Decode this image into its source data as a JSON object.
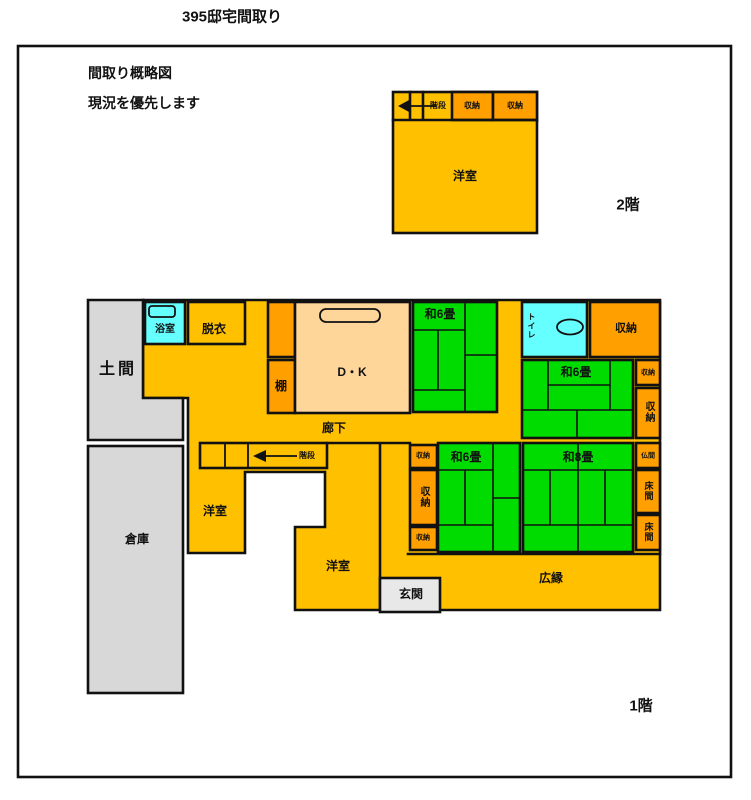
{
  "title": "395邸宅間取り",
  "notes": {
    "line1": "間取り概略図",
    "line2": "現況を優先します"
  },
  "floor_labels": {
    "second": "2階",
    "first": "1階"
  },
  "colors": {
    "yellow": "#FFC000",
    "orange": "#FF9F00",
    "green": "#00DC00",
    "cyan": "#66FFFF",
    "gray": "#D8D8D8",
    "gray_light": "#E8E8E8",
    "tan": "#FFD699",
    "white": "#FFFFFF",
    "wall": "#111111"
  },
  "floor2": {
    "stairs": "階段",
    "closet1": "収納",
    "closet2": "収納",
    "western_room": "洋室"
  },
  "floor1": {
    "doma": "土間",
    "bath": "浴室",
    "dressing": "脱衣",
    "shelf": "棚",
    "dk": "D・K",
    "tatami6_top": "和6畳",
    "toilet": "トイレ",
    "closet_tr": "収納",
    "tatami6_right": "和6畳",
    "closet_r_small": "収納",
    "closet_r_vert": "収納",
    "corridor": "廊下",
    "stairs": "階段",
    "closet_c_top": "収納",
    "closet_c_mid": "収納",
    "closet_c_bottom": "収納",
    "tatami6_bottom": "和6畳",
    "tatami8": "和8畳",
    "butsuma": "仏間",
    "tokonoma_upper": "床間",
    "tokonoma_lower": "床間",
    "western_left": "洋室",
    "western_bottom": "洋室",
    "entrance": "玄関",
    "veranda": "広縁",
    "warehouse": "倉庫"
  }
}
